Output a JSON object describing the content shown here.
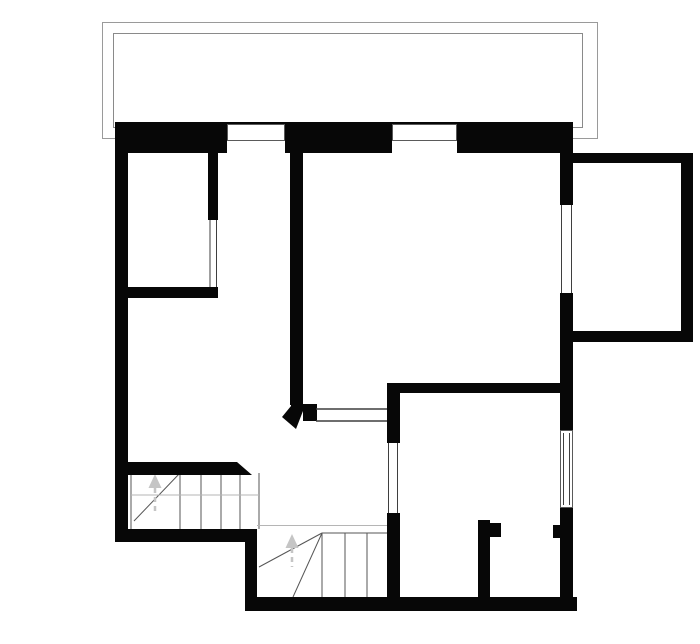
{
  "canvas": {
    "width": 700,
    "height": 644,
    "background": "#ffffff"
  },
  "colors": {
    "wall": "#070707",
    "balcony_outline": "#9a9a9a",
    "balcony_inner_outline": "#8a8a8a",
    "opening_line": "#3f3f3f",
    "stair_line": "#565656",
    "faint_line": "#b5b5b5",
    "window_frame": "#5a5a5a",
    "arrow": "#c5c5c5",
    "white": "#ffffff"
  },
  "plan": {
    "balcony_outlines": [
      {
        "name": "balcony-outer-outline",
        "x": 102.5,
        "y": 22.5,
        "w": 495,
        "h": 116
      },
      {
        "name": "balcony-inner-outline",
        "x": 113.5,
        "y": 33.5,
        "w": 469,
        "h": 94
      }
    ],
    "stair_lines": [
      {
        "name": "upper-stair-left-edge",
        "x1": 131,
        "y1": 473,
        "x2": 131,
        "y2": 529
      },
      {
        "name": "upper-stair-tread-1",
        "x1": 180,
        "y1": 473,
        "x2": 180,
        "y2": 529
      },
      {
        "name": "upper-stair-tread-2",
        "x1": 201,
        "y1": 473,
        "x2": 201,
        "y2": 529
      },
      {
        "name": "upper-stair-tread-3",
        "x1": 221,
        "y1": 473,
        "x2": 221,
        "y2": 529
      },
      {
        "name": "upper-stair-tread-4",
        "x1": 240,
        "y1": 473,
        "x2": 240,
        "y2": 529
      },
      {
        "name": "upper-stair-tread-5",
        "x1": 259,
        "y1": 473,
        "x2": 259,
        "y2": 529
      },
      {
        "name": "upper-stair-winder-diagonal",
        "x1": 180,
        "y1": 473,
        "x2": 134,
        "y2": 521
      },
      {
        "name": "upper-stair-mid-line",
        "x1": 131,
        "y1": 495,
        "x2": 259,
        "y2": 495,
        "faint": true
      },
      {
        "name": "lower-stair-top-edge",
        "x1": 257,
        "y1": 525.5,
        "x2": 387,
        "y2": 525.5,
        "faint": true
      },
      {
        "name": "lower-stair-upper-edge",
        "x1": 322,
        "y1": 533,
        "x2": 387,
        "y2": 533
      },
      {
        "name": "lower-stair-tread-1",
        "x1": 322,
        "y1": 533,
        "x2": 322,
        "y2": 597
      },
      {
        "name": "lower-stair-tread-2",
        "x1": 345,
        "y1": 533,
        "x2": 345,
        "y2": 597
      },
      {
        "name": "lower-stair-tread-3",
        "x1": 367,
        "y1": 533,
        "x2": 367,
        "y2": 597
      },
      {
        "name": "lower-stair-winder-diagonal-1",
        "x1": 322,
        "y1": 533,
        "x2": 259,
        "y2": 567
      },
      {
        "name": "lower-stair-winder-diagonal-2",
        "x1": 322,
        "y1": 533,
        "x2": 293,
        "y2": 597
      }
    ],
    "arrows": [
      {
        "name": "stairs-up-arrow-left",
        "tip_x": 155,
        "tip_y": 474,
        "base_y": 488,
        "half_w": 6.5,
        "tail_y": 514
      },
      {
        "name": "stairs-up-arrow-lower",
        "tip_x": 292,
        "tip_y": 534,
        "base_y": 548,
        "half_w": 6.5,
        "tail_y": 567
      }
    ],
    "walls": [
      {
        "name": "top-exterior-wall",
        "x": 115,
        "y": 122,
        "w": 458,
        "h": 31
      },
      {
        "name": "left-exterior-wall",
        "x": 115,
        "y": 122,
        "w": 13,
        "h": 420
      },
      {
        "name": "bottom-left-exterior-wall",
        "x": 115,
        "y": 529,
        "w": 142,
        "h": 13
      },
      {
        "name": "step-exterior-wall",
        "x": 245,
        "y": 529,
        "w": 12,
        "h": 82
      },
      {
        "name": "bottom-exterior-wall",
        "x": 245,
        "y": 597,
        "w": 332,
        "h": 14
      },
      {
        "name": "right-exterior-wall",
        "x": 560,
        "y": 153,
        "w": 13,
        "h": 458
      },
      {
        "name": "extension-top-wall",
        "x": 573,
        "y": 153,
        "w": 120,
        "h": 10
      },
      {
        "name": "extension-right-wall",
        "x": 681,
        "y": 153,
        "w": 12,
        "h": 189
      },
      {
        "name": "extension-bottom-wall",
        "x": 560,
        "y": 331,
        "w": 133,
        "h": 11
      },
      {
        "name": "left-room-partition-wall",
        "x": 208,
        "y": 153,
        "w": 10,
        "h": 145
      },
      {
        "name": "left-room-bottom-wall",
        "x": 122,
        "y": 287,
        "w": 96,
        "h": 11
      },
      {
        "name": "central-partition-wall",
        "x": 290,
        "y": 153,
        "w": 13,
        "h": 252
      },
      {
        "name": "passage-left-stub",
        "x": 303,
        "y": 404,
        "w": 14,
        "h": 17
      },
      {
        "name": "lower-right-room-left-wall",
        "x": 387,
        "y": 383,
        "w": 13,
        "h": 228
      },
      {
        "name": "lower-right-room-top-wall",
        "x": 387,
        "y": 383,
        "w": 186,
        "h": 10
      },
      {
        "name": "closet-partition-wall",
        "x": 478,
        "y": 520,
        "w": 12,
        "h": 77
      },
      {
        "name": "closet-door-jamb-left",
        "x": 490,
        "y": 523,
        "w": 11,
        "h": 14
      },
      {
        "name": "closet-door-jamb-right",
        "x": 553,
        "y": 525,
        "w": 9,
        "h": 13
      }
    ],
    "wall_polygons": [
      {
        "name": "stair-hall-wall-chamfered",
        "points": "122,462 237,462 252,475 122,475"
      },
      {
        "name": "central-wall-angled-end",
        "points": "291,402 303,402 303,411 296,429 282,417 291,406"
      }
    ],
    "white_openings": [
      {
        "name": "top-window-a-cut",
        "x": 227,
        "y": 124,
        "w": 58,
        "h": 29
      },
      {
        "name": "top-window-b-cut",
        "x": 392,
        "y": 124,
        "w": 65,
        "h": 29
      },
      {
        "name": "extension-doorway-cut",
        "x": 560,
        "y": 205,
        "w": 13,
        "h": 88
      },
      {
        "name": "right-window-cut",
        "x": 560,
        "y": 430,
        "w": 13,
        "h": 78
      },
      {
        "name": "left-room-interior-window-cut",
        "x": 208,
        "y": 220,
        "w": 10,
        "h": 67
      },
      {
        "name": "lower-right-room-doorway-cut",
        "x": 387,
        "y": 443,
        "w": 13,
        "h": 70
      }
    ],
    "outline_rects": [
      {
        "name": "top-window-a-frame",
        "x": 227.5,
        "y": 124.5,
        "w": 57,
        "h": 16
      },
      {
        "name": "top-window-b-frame",
        "x": 392.5,
        "y": 124.5,
        "w": 64,
        "h": 16
      },
      {
        "name": "right-window-frame",
        "x": 560.5,
        "y": 430.5,
        "w": 12,
        "h": 77
      }
    ],
    "opening_lines": [
      {
        "name": "left-room-interior-window-line-1",
        "x1": 210,
        "y1": 220,
        "x2": 210,
        "y2": 287
      },
      {
        "name": "left-room-interior-window-line-2",
        "x1": 216.5,
        "y1": 220,
        "x2": 216.5,
        "y2": 287
      },
      {
        "name": "extension-doorway-line-1",
        "x1": 561.5,
        "y1": 205,
        "x2": 561.5,
        "y2": 293
      },
      {
        "name": "extension-doorway-line-2",
        "x1": 571.5,
        "y1": 205,
        "x2": 571.5,
        "y2": 293
      },
      {
        "name": "lower-right-doorway-line-1",
        "x1": 388.5,
        "y1": 443,
        "x2": 388.5,
        "y2": 513
      },
      {
        "name": "lower-right-doorway-line-2",
        "x1": 397.5,
        "y1": 443,
        "x2": 397.5,
        "y2": 513
      },
      {
        "name": "right-window-inner-line-1",
        "x1": 563.5,
        "y1": 433,
        "x2": 563.5,
        "y2": 505
      },
      {
        "name": "right-window-inner-line-2",
        "x1": 569.5,
        "y1": 433,
        "x2": 569.5,
        "y2": 505
      },
      {
        "name": "passage-threshold-line-top",
        "x1": 316,
        "y1": 409,
        "x2": 387,
        "y2": 409,
        "thick": true
      },
      {
        "name": "passage-threshold-line-bottom",
        "x1": 316,
        "y1": 421,
        "x2": 387,
        "y2": 421,
        "thick": true
      }
    ]
  }
}
